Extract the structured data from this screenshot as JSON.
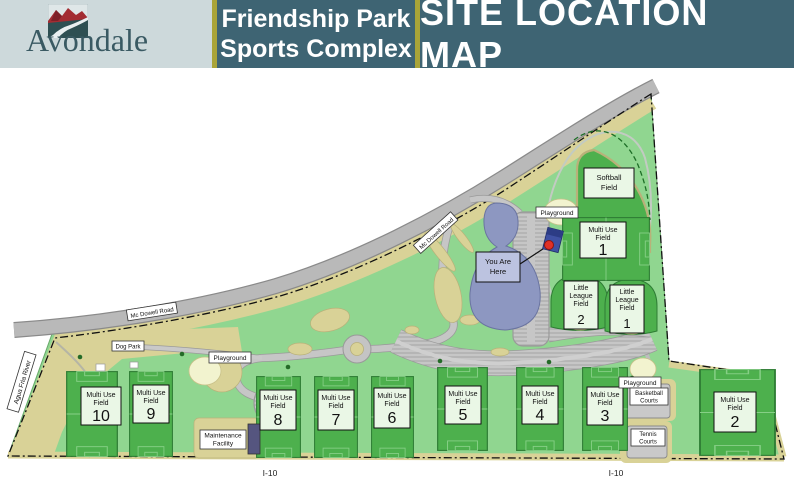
{
  "header": {
    "logo_text": "Avondale",
    "park_name_line1": "Friendship Park",
    "park_name_line2": "Sports Complex",
    "map_title": "SITE LOCATION MAP"
  },
  "map": {
    "roads": {
      "mcdowell_upper": "Mc Dowell Road",
      "mcdowell_lower": "Mc Dowell Road",
      "agua_fria_river": "Agua Fria River",
      "i10_west": "I-10",
      "i10_east": "I-10"
    },
    "marker": {
      "line1": "You Are",
      "line2": "Here"
    },
    "amenities": {
      "playground_north": "Playground",
      "playground_west": "Playground",
      "playground_east": "Playground",
      "dog_park": "Dog Park",
      "maintenance_facility": {
        "line1": "Maintenance",
        "line2": "Facility"
      },
      "basketball_courts": {
        "line1": "Basketball",
        "line2": "Courts"
      },
      "tennis_courts": {
        "line1": "Tennis",
        "line2": "Courts"
      }
    },
    "fields": {
      "softball": {
        "line1": "Softball",
        "line2": "Field"
      },
      "little_league_1": {
        "line1": "Little",
        "line2": "League",
        "line3": "Field",
        "number": "1"
      },
      "little_league_2": {
        "line1": "Little",
        "line2": "League",
        "line3": "Field",
        "number": "2"
      },
      "multi_use_label_line1": "Multi Use",
      "multi_use_label_line2": "Field",
      "multi_use": [
        {
          "number": "1"
        },
        {
          "number": "2"
        },
        {
          "number": "3"
        },
        {
          "number": "4"
        },
        {
          "number": "5"
        },
        {
          "number": "6"
        },
        {
          "number": "7"
        },
        {
          "number": "8"
        },
        {
          "number": "9"
        },
        {
          "number": "10"
        }
      ]
    }
  },
  "colors": {
    "header_teal": "#3e6473",
    "header_light": "#cdd9db",
    "divider_olive": "#a9a438",
    "park_green": "#90d690",
    "field_green": "#4db04d",
    "field_sign_bg": "#eaf7e6",
    "tan": "#d9d297",
    "road_gray": "#b9b9b9",
    "parking_gray": "#c6c6c6",
    "pond_blue": "#8d97c1",
    "marker_red": "#e03127"
  }
}
